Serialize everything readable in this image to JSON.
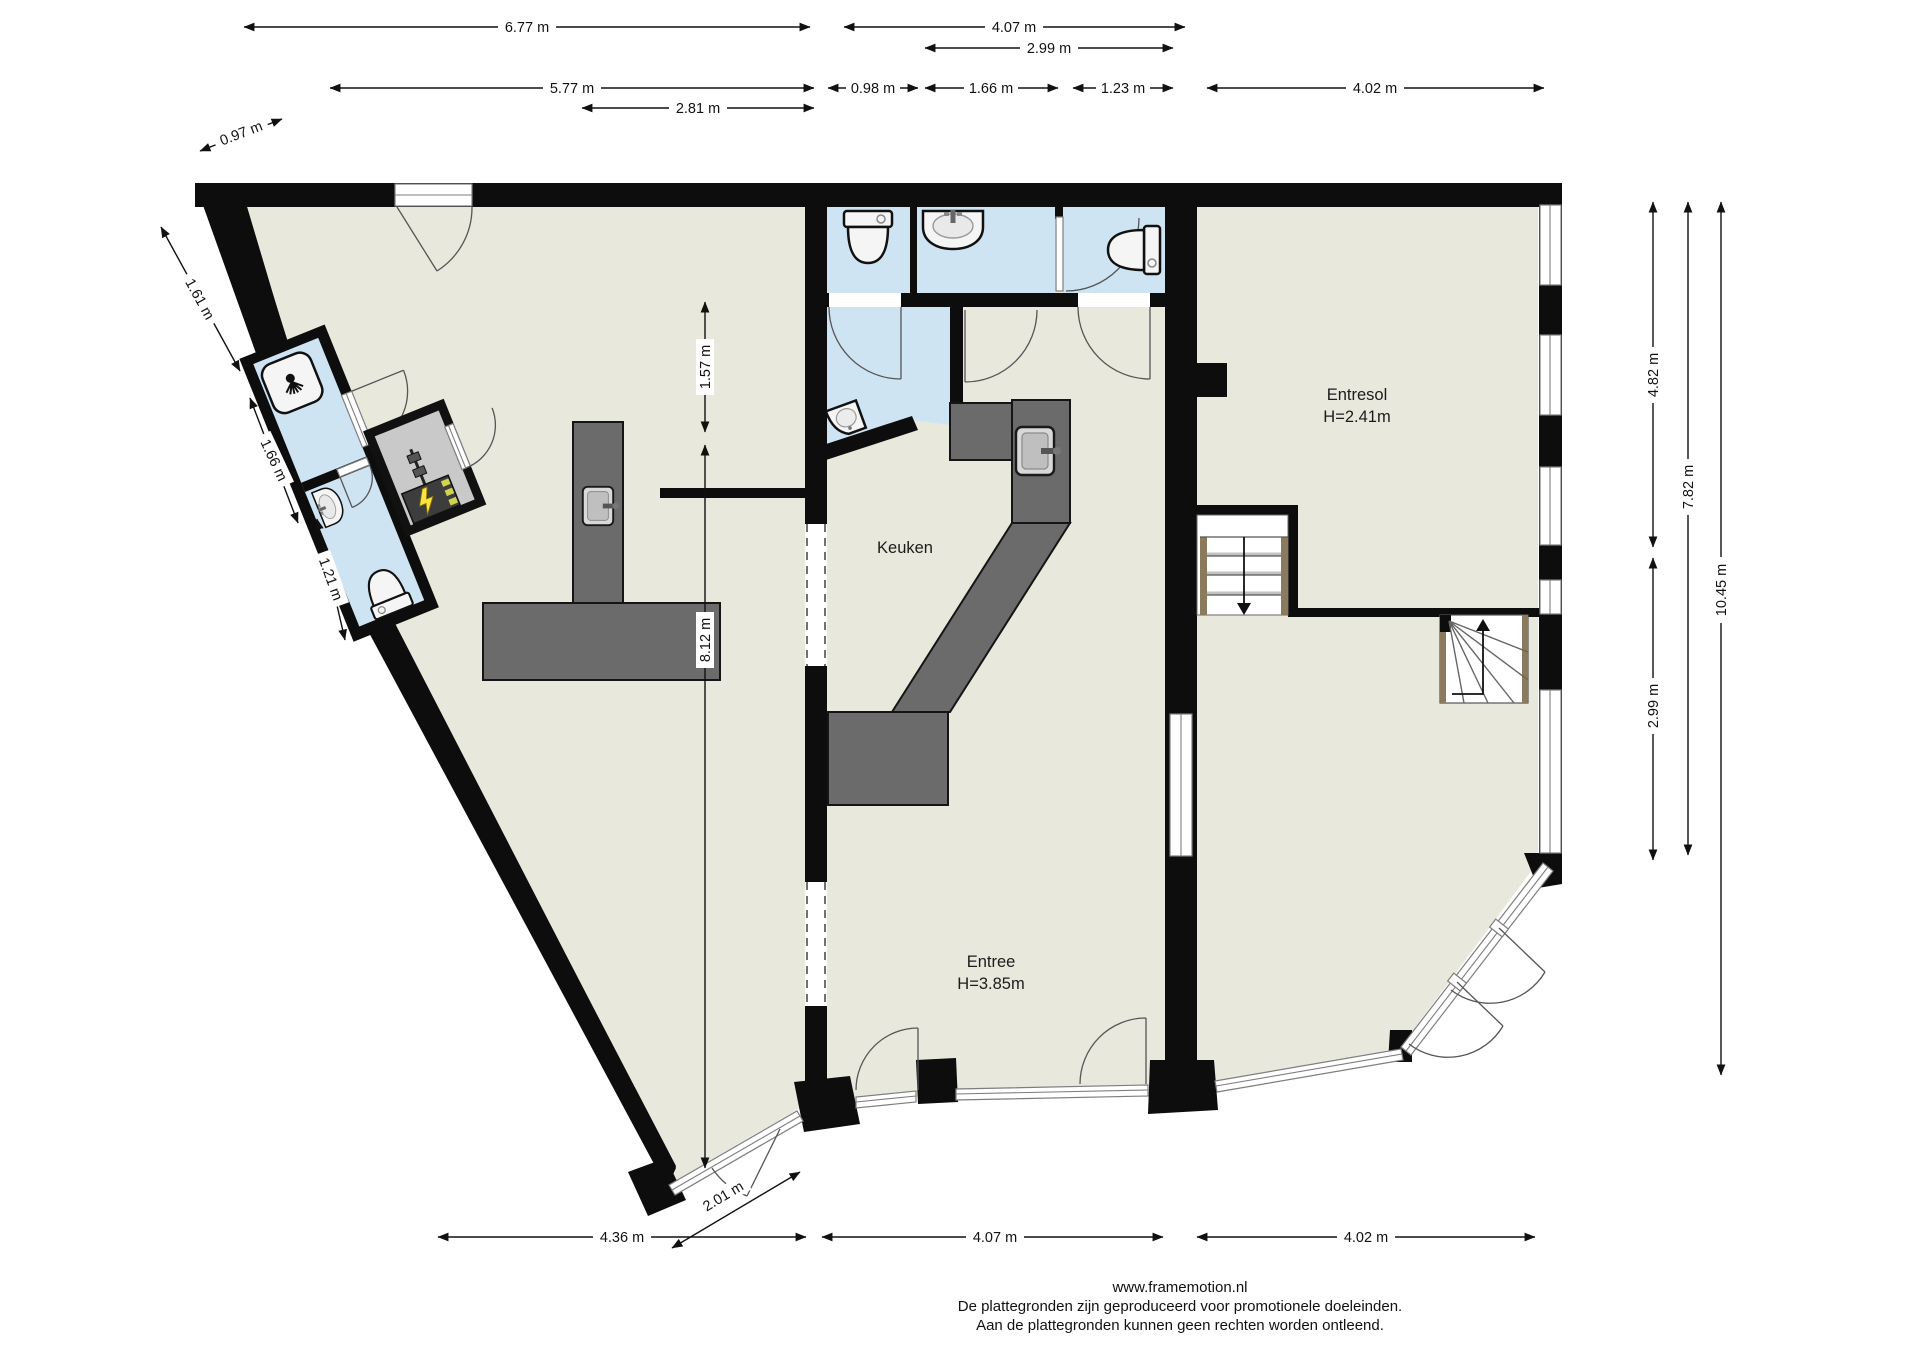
{
  "plan": {
    "type": "floorplan",
    "rooms": {
      "keuken": {
        "label": "Keuken"
      },
      "entresol": {
        "label": "Entresol",
        "height_label": "H=2.41m"
      },
      "entree": {
        "label": "Entree",
        "height_label": "H=3.85m"
      }
    },
    "dims": {
      "t677": "6.77 m",
      "t407": "4.07 m",
      "t299": "2.99 m",
      "t577": "5.77 m",
      "t098": "0.98 m",
      "t166": "1.66 m",
      "t123": "1.23 m",
      "t402": "4.02 m",
      "t281": "2.81 m",
      "t097": "0.97 m",
      "l161": "1.61 m",
      "l166": "1.66 m",
      "l121": "1.21 m",
      "m157": "1.57 m",
      "m812": "8.12 m",
      "r482": "4.82 m",
      "r782": "7.82 m",
      "r1045": "10.45 m",
      "r299": "2.99 m",
      "b436": "4.36 m",
      "b201": "2.01 m",
      "b407": "4.07 m",
      "b402": "4.02 m"
    },
    "colors": {
      "wall": "#0d0d0d",
      "floor": "#e9e8dd",
      "wet_room": "#cfe4f3",
      "counter": "#6b6b6b",
      "meter_room": "#c9c9c9",
      "stair_stringer": "#8b7a5d"
    }
  },
  "footer": {
    "website": "www.framemotion.nl",
    "disclaimer1": "De plattegronden zijn geproduceerd voor promotionele doeleinden.",
    "disclaimer2": "Aan de plattegronden kunnen geen rechten worden ontleend."
  }
}
